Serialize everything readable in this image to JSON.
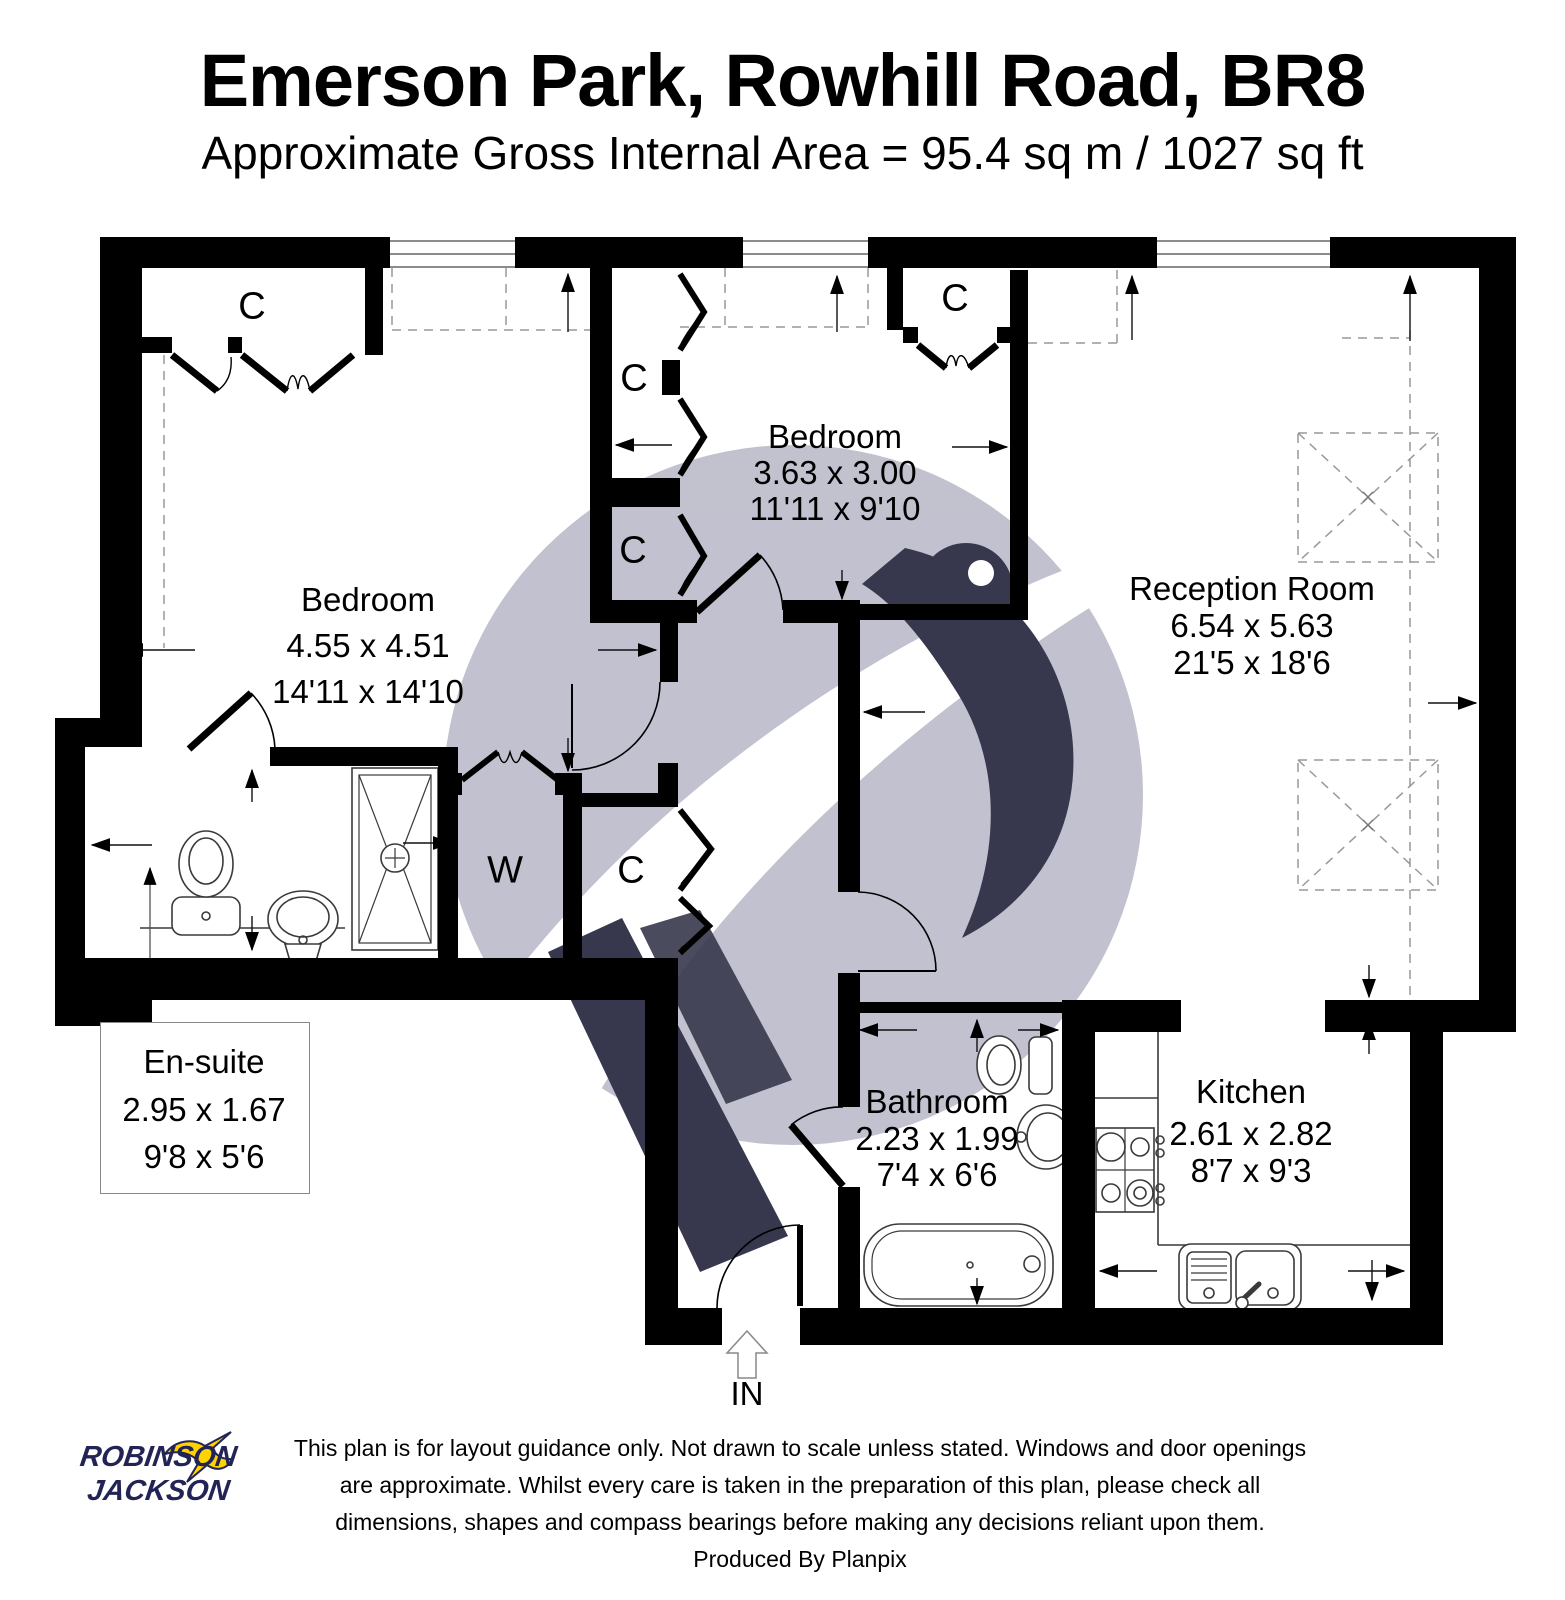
{
  "header": {
    "title": "Emerson Park, Rowhill Road, BR8",
    "subtitle": "Approximate Gross Internal Area = 95.4 sq m / 1027 sq ft"
  },
  "rooms": {
    "bedroom1": {
      "name": "Bedroom",
      "metric": "4.55 x 4.51",
      "imperial": "14'11 x 14'10"
    },
    "bedroom2": {
      "name": "Bedroom",
      "metric": "3.63 x 3.00",
      "imperial": "11'11 x 9'10"
    },
    "reception": {
      "name": "Reception Room",
      "metric": "6.54 x 5.63",
      "imperial": "21'5 x 18'6"
    },
    "kitchen": {
      "name": "Kitchen",
      "metric": "2.61 x 2.82",
      "imperial": "8'7 x 9'3"
    },
    "bathroom": {
      "name": "Bathroom",
      "metric": "2.23 x 1.99",
      "imperial": "7'4 x 6'6"
    },
    "ensuite": {
      "name": "En-suite",
      "metric": "2.95 x 1.67",
      "imperial": "9'8 x 5'6"
    }
  },
  "closets": {
    "bedroom1": "C",
    "bedroom2_left_top": "C",
    "bedroom2_left_bottom": "C",
    "bedroom2_corner": "C",
    "wardrobe": "W",
    "hall": "C"
  },
  "entrance": {
    "label": "IN"
  },
  "footer": {
    "line1": "This plan is for layout guidance only. Not drawn to scale unless stated. Windows and door openings",
    "line2": "are approximate. Whilst every care is taken in the preparation of this plan, please check all",
    "line3": "dimensions, shapes and compass bearings before making any decisions reliant upon them.",
    "line4": "Produced By Planpix"
  },
  "logo": {
    "line1": "ROBINSON",
    "line2": "JACKSON"
  },
  "colors": {
    "wall": "#000000",
    "watermark_gray": "#b7b7c7",
    "watermark_navy": "#15152f",
    "logo_navy": "#232456",
    "logo_yellow": "#ffd200"
  }
}
